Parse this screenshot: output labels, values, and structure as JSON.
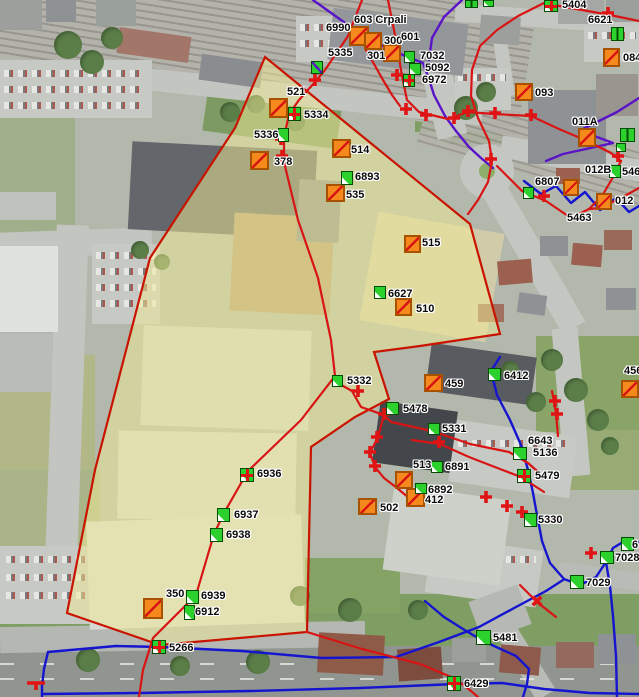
{
  "map": {
    "overlay": {
      "points": "265,57 470,224 500,334 420,346 374,352 389,399 355,417 311,447 307,632 160,645 67,613 95,470 150,258 235,128",
      "fill": "#f1eb96",
      "fill_opacity": 0.5,
      "stroke": "#c81400"
    },
    "colors": {
      "orange_marker": "#f5891b",
      "green_marker": "#2dd12d",
      "red_line": "#d81414",
      "blue_line": "#1515cf",
      "purple_line": "#5a14c8"
    },
    "labels": [
      {
        "text": "603 Crpali",
        "x": 354,
        "y": 15
      },
      {
        "text": "6990",
        "x": 326,
        "y": 23
      },
      {
        "text": "300",
        "x": 384,
        "y": 36
      },
      {
        "text": "601",
        "x": 401,
        "y": 32
      },
      {
        "text": "301",
        "x": 367,
        "y": 51
      },
      {
        "text": "5335",
        "x": 328,
        "y": 48
      },
      {
        "text": "7032",
        "x": 420,
        "y": 51
      },
      {
        "text": "5092",
        "x": 425,
        "y": 63
      },
      {
        "text": "6972",
        "x": 422,
        "y": 75
      },
      {
        "text": "5404",
        "x": 562,
        "y": 0
      },
      {
        "text": "6621",
        "x": 588,
        "y": 15
      },
      {
        "text": "084",
        "x": 623,
        "y": 53
      },
      {
        "text": "093",
        "x": 535,
        "y": 88
      },
      {
        "text": "011A",
        "x": 572,
        "y": 117
      },
      {
        "text": "012B",
        "x": 585,
        "y": 165
      },
      {
        "text": "546",
        "x": 622,
        "y": 167
      },
      {
        "text": "6807",
        "x": 535,
        "y": 177
      },
      {
        "text": "012",
        "x": 615,
        "y": 196
      },
      {
        "text": "5463",
        "x": 567,
        "y": 213
      },
      {
        "text": "521",
        "x": 287,
        "y": 87
      },
      {
        "text": "5334",
        "x": 304,
        "y": 110
      },
      {
        "text": "5336",
        "x": 254,
        "y": 130
      },
      {
        "text": "378",
        "x": 274,
        "y": 157
      },
      {
        "text": "514",
        "x": 351,
        "y": 145
      },
      {
        "text": "6893",
        "x": 355,
        "y": 172
      },
      {
        "text": "535",
        "x": 346,
        "y": 190
      },
      {
        "text": "515",
        "x": 422,
        "y": 238
      },
      {
        "text": "6627",
        "x": 388,
        "y": 289
      },
      {
        "text": "510",
        "x": 416,
        "y": 304
      },
      {
        "text": "5332",
        "x": 347,
        "y": 376
      },
      {
        "text": "459",
        "x": 445,
        "y": 379
      },
      {
        "text": "5478",
        "x": 403,
        "y": 404
      },
      {
        "text": "5331",
        "x": 442,
        "y": 424
      },
      {
        "text": "6412",
        "x": 504,
        "y": 371
      },
      {
        "text": "456",
        "x": 624,
        "y": 366
      },
      {
        "text": "513",
        "x": 413,
        "y": 460
      },
      {
        "text": "6891",
        "x": 445,
        "y": 462
      },
      {
        "text": "6892",
        "x": 428,
        "y": 485
      },
      {
        "text": "412",
        "x": 425,
        "y": 495
      },
      {
        "text": "502",
        "x": 380,
        "y": 503
      },
      {
        "text": "6643",
        "x": 528,
        "y": 436
      },
      {
        "text": "5136",
        "x": 533,
        "y": 448
      },
      {
        "text": "5479",
        "x": 535,
        "y": 471
      },
      {
        "text": "5330",
        "x": 538,
        "y": 515
      },
      {
        "text": "6",
        "x": 632,
        "y": 540
      },
      {
        "text": "7028",
        "x": 615,
        "y": 553
      },
      {
        "text": "7029",
        "x": 586,
        "y": 578
      },
      {
        "text": "6936",
        "x": 257,
        "y": 469
      },
      {
        "text": "6937",
        "x": 234,
        "y": 510
      },
      {
        "text": "6938",
        "x": 226,
        "y": 530
      },
      {
        "text": "350",
        "x": 166,
        "y": 589
      },
      {
        "text": "6939",
        "x": 201,
        "y": 591
      },
      {
        "text": "6912",
        "x": 195,
        "y": 607
      },
      {
        "text": "5266",
        "x": 169,
        "y": 643
      },
      {
        "text": "5481",
        "x": 493,
        "y": 633
      },
      {
        "text": "6429",
        "x": 464,
        "y": 679
      }
    ],
    "orange_markers": [
      {
        "label": "6990",
        "x": 349,
        "y": 26,
        "w": 20,
        "h": 20
      },
      {
        "label": "300",
        "x": 364,
        "y": 32,
        "w": 18,
        "h": 18
      },
      {
        "label": "301",
        "x": 383,
        "y": 44,
        "w": 18,
        "h": 18
      },
      {
        "label": "093",
        "x": 515,
        "y": 83,
        "w": 18,
        "h": 18
      },
      {
        "label": "084",
        "x": 603,
        "y": 48,
        "w": 17,
        "h": 19
      },
      {
        "label": "011A",
        "x": 578,
        "y": 128,
        "w": 18,
        "h": 19
      },
      {
        "label": "6807",
        "x": 563,
        "y": 179,
        "w": 16,
        "h": 17
      },
      {
        "label": "012",
        "x": 596,
        "y": 193,
        "w": 16,
        "h": 17
      },
      {
        "label": "456",
        "x": 621,
        "y": 380,
        "w": 18,
        "h": 18
      },
      {
        "label": "5334",
        "x": 269,
        "y": 98,
        "w": 19,
        "h": 20
      },
      {
        "label": "378",
        "x": 250,
        "y": 151,
        "w": 19,
        "h": 19
      },
      {
        "label": "514",
        "x": 332,
        "y": 139,
        "w": 19,
        "h": 19
      },
      {
        "label": "535",
        "x": 326,
        "y": 184,
        "w": 19,
        "h": 18
      },
      {
        "label": "515",
        "x": 404,
        "y": 235,
        "w": 17,
        "h": 18
      },
      {
        "label": "510",
        "x": 395,
        "y": 298,
        "w": 17,
        "h": 18
      },
      {
        "label": "459",
        "x": 424,
        "y": 374,
        "w": 19,
        "h": 18
      },
      {
        "label": "513",
        "x": 395,
        "y": 471,
        "w": 18,
        "h": 18
      },
      {
        "label": "412",
        "x": 406,
        "y": 488,
        "w": 19,
        "h": 19
      },
      {
        "label": "502",
        "x": 358,
        "y": 498,
        "w": 19,
        "h": 17
      },
      {
        "label": "6912",
        "x": 143,
        "y": 598,
        "w": 20,
        "h": 21
      }
    ],
    "green_markers": [
      {
        "label": "5335",
        "x": 311,
        "y": 61,
        "w": 12,
        "h": 13,
        "variant": "diag"
      },
      {
        "label": "7032",
        "x": 404,
        "y": 51,
        "w": 11,
        "h": 12,
        "variant": "wedge"
      },
      {
        "label": "5092",
        "x": 409,
        "y": 63,
        "w": 12,
        "h": 12,
        "variant": "wedge"
      },
      {
        "label": "6972",
        "x": 403,
        "y": 74,
        "w": 12,
        "h": 13,
        "variant": "cross"
      },
      {
        "label": "5404",
        "x": 544,
        "y": 0,
        "w": 14,
        "h": 12,
        "variant": "cross"
      },
      {
        "label": "6621",
        "x": 611,
        "y": 27,
        "w": 13,
        "h": 14,
        "variant": "pair"
      },
      {
        "label": "",
        "x": 465,
        "y": 0,
        "w": 13,
        "h": 8,
        "variant": "pair"
      },
      {
        "label": "",
        "x": 483,
        "y": 0,
        "w": 11,
        "h": 7,
        "variant": "wedge"
      },
      {
        "label": "011A",
        "x": 620,
        "y": 128,
        "w": 15,
        "h": 14,
        "variant": "pair"
      },
      {
        "label": "",
        "x": 616,
        "y": 143,
        "w": 10,
        "h": 9,
        "variant": "wedge"
      },
      {
        "label": "012B",
        "x": 609,
        "y": 165,
        "w": 12,
        "h": 13,
        "variant": "wedge"
      },
      {
        "label": "6807",
        "x": 523,
        "y": 187,
        "w": 11,
        "h": 12,
        "variant": "wedge"
      },
      {
        "label": "5334",
        "x": 288,
        "y": 107,
        "w": 13,
        "h": 14,
        "variant": "cross"
      },
      {
        "label": "5336",
        "x": 278,
        "y": 128,
        "w": 11,
        "h": 14,
        "variant": "wedge"
      },
      {
        "label": "6893",
        "x": 341,
        "y": 171,
        "w": 12,
        "h": 14,
        "variant": "wedge"
      },
      {
        "label": "6627",
        "x": 374,
        "y": 286,
        "w": 12,
        "h": 13,
        "variant": "wedge"
      },
      {
        "label": "5332",
        "x": 332,
        "y": 375,
        "w": 11,
        "h": 12,
        "variant": "wedge"
      },
      {
        "label": "5478",
        "x": 386,
        "y": 402,
        "w": 13,
        "h": 13,
        "variant": "wedge"
      },
      {
        "label": "5331",
        "x": 428,
        "y": 423,
        "w": 12,
        "h": 12,
        "variant": "wedge"
      },
      {
        "label": "6891",
        "x": 431,
        "y": 461,
        "w": 12,
        "h": 12,
        "variant": "wedge"
      },
      {
        "label": "6892",
        "x": 415,
        "y": 483,
        "w": 12,
        "h": 11,
        "variant": "wedge"
      },
      {
        "label": "6412",
        "x": 488,
        "y": 368,
        "w": 13,
        "h": 13,
        "variant": "wedge"
      },
      {
        "label": "5136",
        "x": 513,
        "y": 447,
        "w": 14,
        "h": 13,
        "variant": "wedge"
      },
      {
        "label": "5479",
        "x": 517,
        "y": 469,
        "w": 14,
        "h": 14,
        "variant": "cross"
      },
      {
        "label": "5330",
        "x": 524,
        "y": 513,
        "w": 13,
        "h": 14,
        "variant": "wedge"
      },
      {
        "label": "6",
        "x": 621,
        "y": 537,
        "w": 13,
        "h": 14,
        "variant": "wedge"
      },
      {
        "label": "7028",
        "x": 600,
        "y": 551,
        "w": 14,
        "h": 13,
        "variant": "wedge"
      },
      {
        "label": "7029",
        "x": 570,
        "y": 575,
        "w": 14,
        "h": 14,
        "variant": "wedge"
      },
      {
        "label": "6936",
        "x": 240,
        "y": 468,
        "w": 14,
        "h": 14,
        "variant": "cross"
      },
      {
        "label": "6937",
        "x": 217,
        "y": 508,
        "w": 13,
        "h": 14,
        "variant": "wedge"
      },
      {
        "label": "6938",
        "x": 210,
        "y": 528,
        "w": 13,
        "h": 14,
        "variant": "wedge"
      },
      {
        "label": "6939",
        "x": 186,
        "y": 590,
        "w": 13,
        "h": 14,
        "variant": "wedge"
      },
      {
        "label": "6912",
        "x": 184,
        "y": 605,
        "w": 11,
        "h": 15,
        "variant": "wedge"
      },
      {
        "label": "5266",
        "x": 152,
        "y": 640,
        "w": 14,
        "h": 14,
        "variant": "cross"
      },
      {
        "label": "5481",
        "x": 476,
        "y": 630,
        "w": 15,
        "h": 15,
        "variant": "wedge"
      },
      {
        "label": "6429",
        "x": 447,
        "y": 676,
        "w": 14,
        "h": 15,
        "variant": "cross"
      }
    ],
    "crosses": [
      {
        "x": 315,
        "y": 80,
        "type": "plus"
      },
      {
        "x": 397,
        "y": 75,
        "type": "plus"
      },
      {
        "x": 406,
        "y": 109,
        "type": "plus"
      },
      {
        "x": 426,
        "y": 115,
        "type": "plus"
      },
      {
        "x": 454,
        "y": 118,
        "type": "plus"
      },
      {
        "x": 468,
        "y": 111,
        "type": "plus"
      },
      {
        "x": 495,
        "y": 113,
        "type": "plus"
      },
      {
        "x": 531,
        "y": 115,
        "type": "plus"
      },
      {
        "x": 608,
        "y": 13,
        "type": "plus"
      },
      {
        "x": 618,
        "y": 156,
        "type": "plus"
      },
      {
        "x": 491,
        "y": 159,
        "type": "plus"
      },
      {
        "x": 544,
        "y": 196,
        "type": "plus"
      },
      {
        "x": 281,
        "y": 139,
        "type": "plus"
      },
      {
        "x": 282,
        "y": 156,
        "type": "plus"
      },
      {
        "x": 384,
        "y": 414,
        "type": "plus"
      },
      {
        "x": 377,
        "y": 437,
        "type": "plus"
      },
      {
        "x": 370,
        "y": 452,
        "type": "plus"
      },
      {
        "x": 375,
        "y": 466,
        "type": "plus"
      },
      {
        "x": 358,
        "y": 391,
        "type": "plus"
      },
      {
        "x": 439,
        "y": 442,
        "type": "plus"
      },
      {
        "x": 486,
        "y": 497,
        "type": "plus"
      },
      {
        "x": 507,
        "y": 506,
        "type": "plus"
      },
      {
        "x": 522,
        "y": 512,
        "type": "plus"
      },
      {
        "x": 555,
        "y": 401,
        "type": "plus"
      },
      {
        "x": 557,
        "y": 414,
        "type": "plus"
      },
      {
        "x": 591,
        "y": 553,
        "type": "plus"
      },
      {
        "x": 537,
        "y": 601,
        "type": "x"
      },
      {
        "x": 36,
        "y": 683,
        "type": "bar"
      }
    ],
    "lines": {
      "red": [
        "362,0 348,36 325,70 315,82 299,100 289,114 284,138 284,162 298,220 318,278 331,340 335,376 301,420 248,471 224,513 214,534 196,595 153,638 143,670 139,697",
        "388,0 396,40 402,76 407,100 419,112 448,119 468,112 494,114 531,116 559,129 585,140 611,153 621,161",
        "621,161 612,179 602,196 589,209 571,218 546,201 522,191 497,166",
        "639,188 621,198 600,208 589,209",
        "546,2 518,16 497,30 480,46 472,70 471,96 478,118 489,141 492,161 488,182 478,200 468,214",
        "548,4 582,10 610,15 639,21",
        "366,50 374,64 383,80 392,95 400,106",
        "336,382 352,391 361,407 384,415 378,437 370,453 375,467 384,478 397,488 409,498",
        "384,415 391,422 432,431 470,444 509,452 528,463 545,478",
        "412,440 440,444 469,457 500,469 521,477 544,492",
        "307,632 362,649 420,664 456,679 471,691 478,697",
        "552,391 556,413 558,436",
        "520,585 537,602 556,617"
      ],
      "blue": [
        "524,181 541,194 556,186 571,203 585,192 600,210 616,198 629,212 639,206",
        "500,357 491,371 497,395 510,420 521,445 528,470 533,493 537,515 542,541 550,563 564,579 580,585 596,577 606,562 613,548 623,542 634,544 639,542",
        "606,562 610,586 613,616 616,656 617,697",
        "48,652 116,646 161,647 242,651 322,658 396,657 439,642 479,627 516,607 546,591 563,580",
        "48,652 44,669 42,686 42,697",
        "425,601 444,617 463,629 478,638 494,646 516,656 529,669 527,684 523,697",
        "42,694 140,693 250,691 360,688 456,684 502,683 544,689 590,693 639,694"
      ],
      "purple": [
        "313,0 341,20 366,38 398,53 423,63 429,79 434,95 445,116 456,131 469,147 481,158 493,168",
        "462,0 444,17 432,38 429,60",
        "639,98 617,112 593,124 579,131 597,137 613,143 586,149 563,154 546,161"
      ]
    }
  }
}
